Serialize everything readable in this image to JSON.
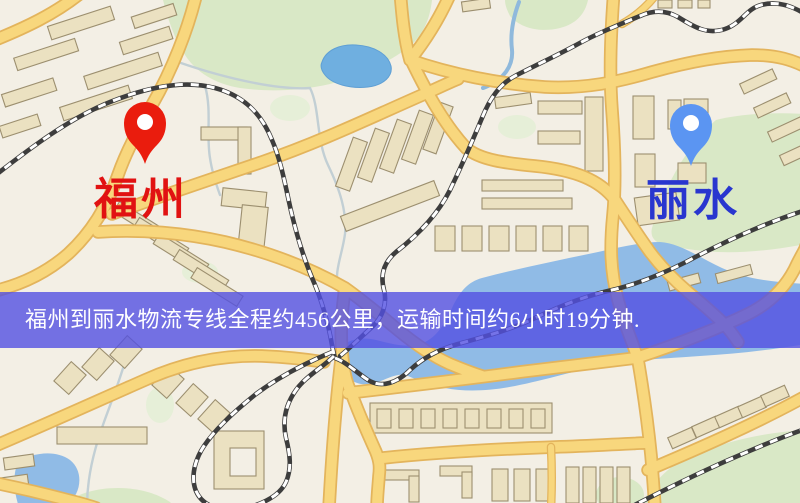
{
  "banner": {
    "text": "福州到丽水物流专线全程约456公里，运输时间约6小时19分钟.",
    "text_color": "#ffffff",
    "background_color": "rgba(82,80,226,0.8)"
  },
  "markers": {
    "origin": {
      "label": "福州",
      "pin_color": "#ea1c0d",
      "label_color": "#e11212"
    },
    "destination": {
      "label": "丽水",
      "pin_color": "#5b95f2",
      "label_color": "#2936cf"
    }
  },
  "route": {
    "distance": "约456公里",
    "duration": "约6小时19分钟"
  },
  "css_vars": {
    "banner-bg": "rgba(82,80,226,0.8)",
    "banner-text": "#ffffff",
    "origin-pin": "#ea1c0d",
    "origin-pin-hole": "#ffffff",
    "origin-label": "#e11212",
    "dest-pin": "#5b95f2",
    "dest-pin-hole": "#ffffff",
    "dest-label": "#2936cf",
    "map-bg": "#f3efe5",
    "road-fill": "#f8d77d",
    "road-casing": "#e3b45c",
    "bld-fill": "#ebe1c1",
    "bld-stroke": "#9c8f6f",
    "park": "#d9e8c6",
    "park-pale": "#e6efd8",
    "water": "#90bbe6",
    "lake": "#6fafe0",
    "lake-stroke": "#5f9fd4",
    "rail": "#3d3d3d",
    "rail-dash": "#ffffff",
    "stream": "#c2cfd4",
    "river": "#8fb9dc"
  }
}
